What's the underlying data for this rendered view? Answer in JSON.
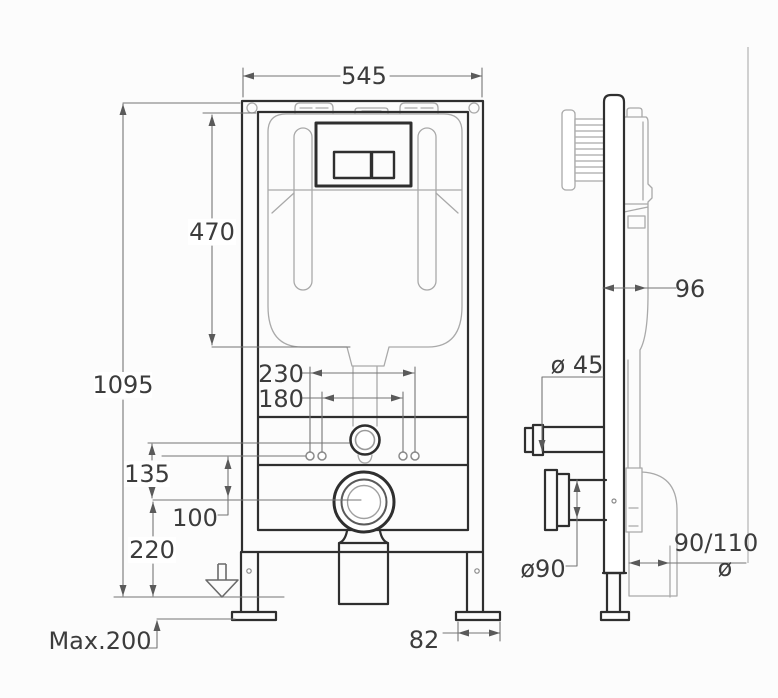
{
  "front_view": {
    "width": "545",
    "overall_height": "1095",
    "cistern_height": "470",
    "fixing_centers_outer": "230",
    "fixing_centers_inner": "180",
    "inlet_to_outlet_offset": "135",
    "bracket_to_outlet_offset": "100",
    "outlet_center_height": "220",
    "foot_adjustment": "Max.200",
    "foot_plate_width": "82"
  },
  "side_view": {
    "frame_depth": "96",
    "flush_pipe_diameter": "ø 45",
    "outlet_pipe_diameter": "ø90",
    "outlet_elbow_size": "90/110",
    "elbow_diameter_symbol": "ø"
  },
  "colors": {
    "background": "#fcfcfc",
    "outline": "#2f2f2f",
    "detail_gray": "#a9a9a9",
    "dimension_gray": "#757575",
    "label_text": "#3c3c3c"
  }
}
